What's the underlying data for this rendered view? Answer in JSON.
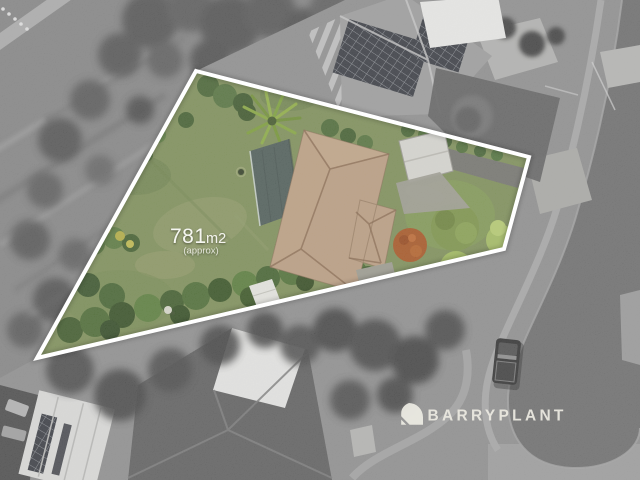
{
  "overlay": {
    "land_area": {
      "value": "781",
      "unit": "m2",
      "qualifier": "(approx)"
    }
  },
  "watermark": {
    "brand_name": "BARRYPLANT",
    "icon": "barry-plant-quadrant-icon"
  },
  "palette": {
    "boundary": "#ffffff",
    "lawn": "#7c8e55",
    "roof_tiles": "#bb9d7f",
    "shed_roof": "#4b5a55",
    "orange_shrub": "#a7531f",
    "road_asphalt": "#6b6b6b",
    "watermark_text": "#eceae2"
  }
}
